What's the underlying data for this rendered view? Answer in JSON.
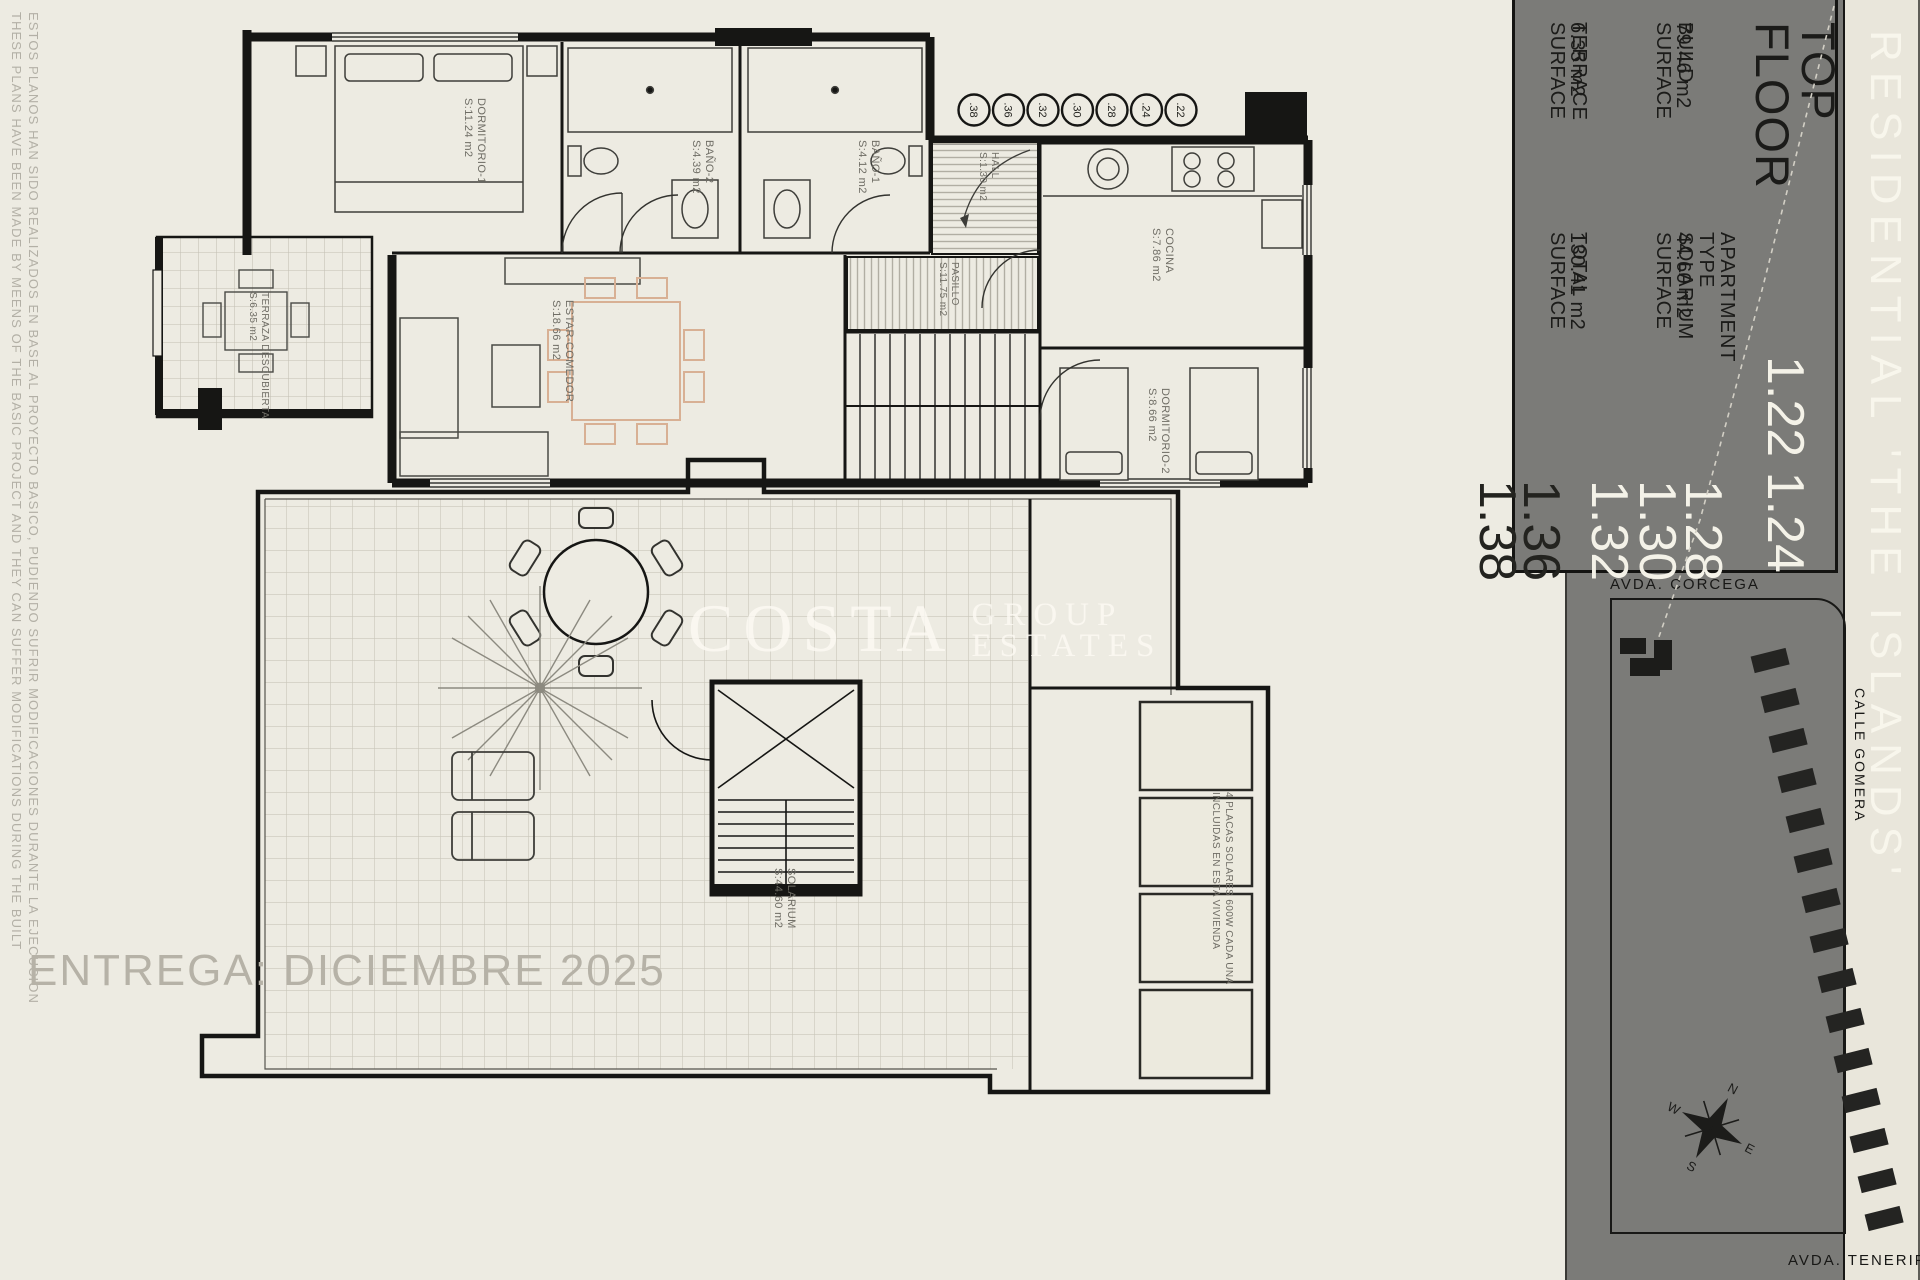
{
  "page": {
    "background": "#edebe2",
    "delivery_note": "ENTREGA: DICIEMBRE 2025"
  },
  "disclaimer": {
    "english": "THESE PLANS HAVE BEEN MADE BY MEENS OF THE BASIC PROJECT AND THEY CAN SUFFER MODIFICATIONS DURING THE BUILT",
    "spanish": "ESTOS PLANOS HAN SIDO REALIZADOS EN BASE AL PROYECTO BASICO, PUDIENDO SUFRIR MODIFICACIONES DURANTE LA EJECUCION"
  },
  "watermark": {
    "word_large": "COSTA",
    "word_top": "GROUP",
    "word_bottom": "ESTATES"
  },
  "top_floor_plan": {
    "rooms": [
      {
        "name": "DORMITORIO-1",
        "area": "S:11.24 m2"
      },
      {
        "name": "BAÑO-2",
        "area": "S:4.39 m2"
      },
      {
        "name": "BAÑO-1",
        "area": "S:4.12 m2"
      },
      {
        "name": "HALL",
        "area": "S:1.30 m2"
      },
      {
        "name": "PASILLO",
        "area": "S:11.75 m2"
      },
      {
        "name": "COCINA",
        "area": "S:7.86 m2"
      },
      {
        "name": "ESTAR-COMEDOR",
        "area": "S:18.66 m2"
      },
      {
        "name": "DORMITORIO-2",
        "area": "S:8.66 m2"
      },
      {
        "name": "TERRAZA DESCUBIERTA",
        "area": "S:6.35 m2"
      }
    ],
    "unit_circles": [
      ".38",
      ".36",
      ".32",
      ".30",
      ".28",
      ".24",
      ".22"
    ]
  },
  "solarium_plan": {
    "room": {
      "name": "SOLARIUM",
      "area": "S:44.60 m2"
    },
    "solar_note": {
      "line1": "4 PLACAS SOLARES 600W CADA UNA",
      "line2": "INCLUIDAS EN ESTA VIVIENDA"
    }
  },
  "sidebar": {
    "project_title": "RESIDENTIAL 'THE ISLANDS'",
    "panel": {
      "floor_label": "TOP FLOOR",
      "apartment_label": "APARTMENT TYPE",
      "apartment_headline_numbers": "1.22 1.24",
      "apartment_numbers_light": [
        "1.28",
        "1.30",
        "1.32"
      ],
      "apartment_numbers_dark": [
        "1.36",
        "1.38"
      ],
      "metrics": [
        {
          "label": "BUILD SURFACE",
          "value": "79.46 m2"
        },
        {
          "label": "SOLARIUM SURFACE",
          "value": "44.60 m2"
        },
        {
          "label": "TERRACE SURFACE",
          "value": "6.35 m2"
        },
        {
          "label": "TOTAL SURFACE",
          "value": "130.41 m2"
        }
      ]
    },
    "map": {
      "street_top": "AVDA. CORCEGA",
      "street_right": "CALLE GOMERA",
      "street_bottom": "AVDA. TENERIFE",
      "compass": {
        "n": "N",
        "e": "E",
        "s": "S",
        "w": "W"
      }
    },
    "colors": {
      "sidebar_gray": "#7b7b78",
      "strip_light": "#e9e6db",
      "number_light": "#f4f2e8"
    }
  }
}
